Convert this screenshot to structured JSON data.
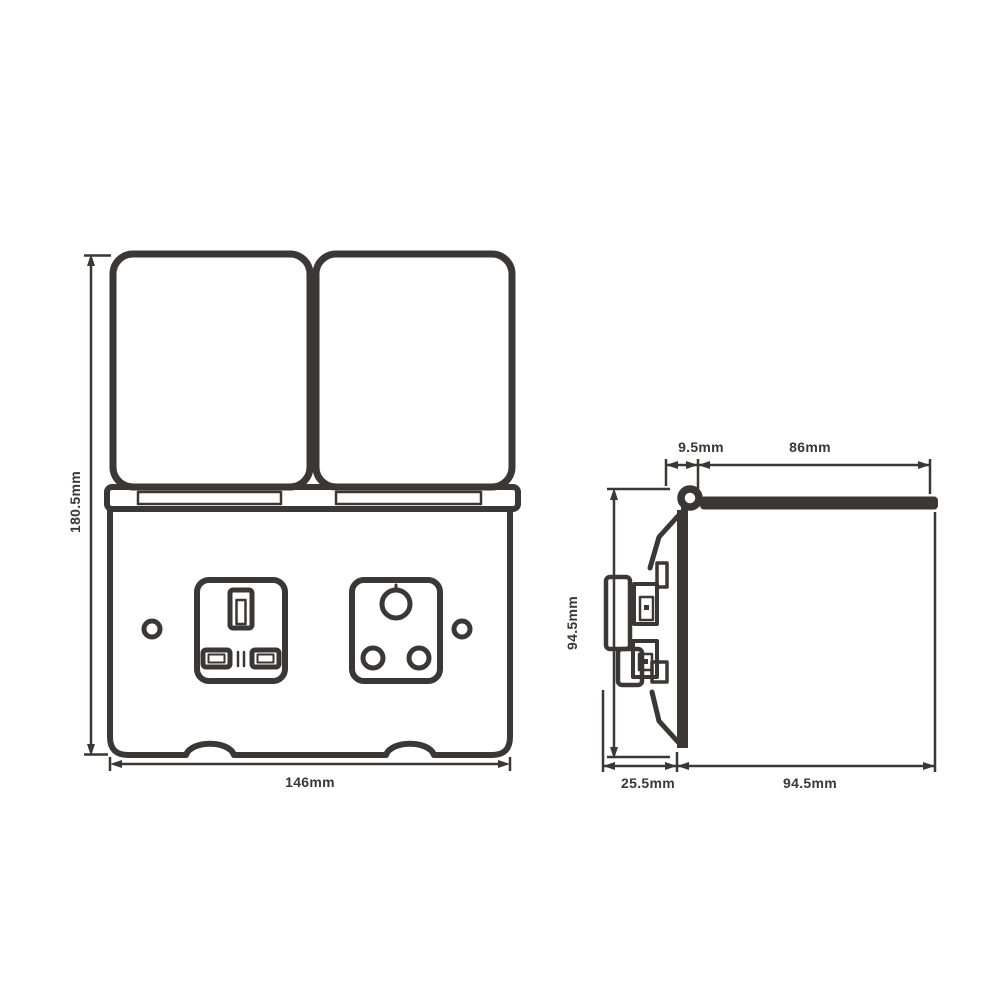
{
  "colors": {
    "background": "#ffffff",
    "line": "#3a3734"
  },
  "front_view": {
    "height_label": "180.5mm",
    "width_label": "146mm"
  },
  "side_view": {
    "hinge_offset_label": "9.5mm",
    "cover_length_label": "86mm",
    "height_label": "94.5mm",
    "box_depth_label": "25.5mm",
    "open_cover_depth_label": "94.5mm"
  }
}
